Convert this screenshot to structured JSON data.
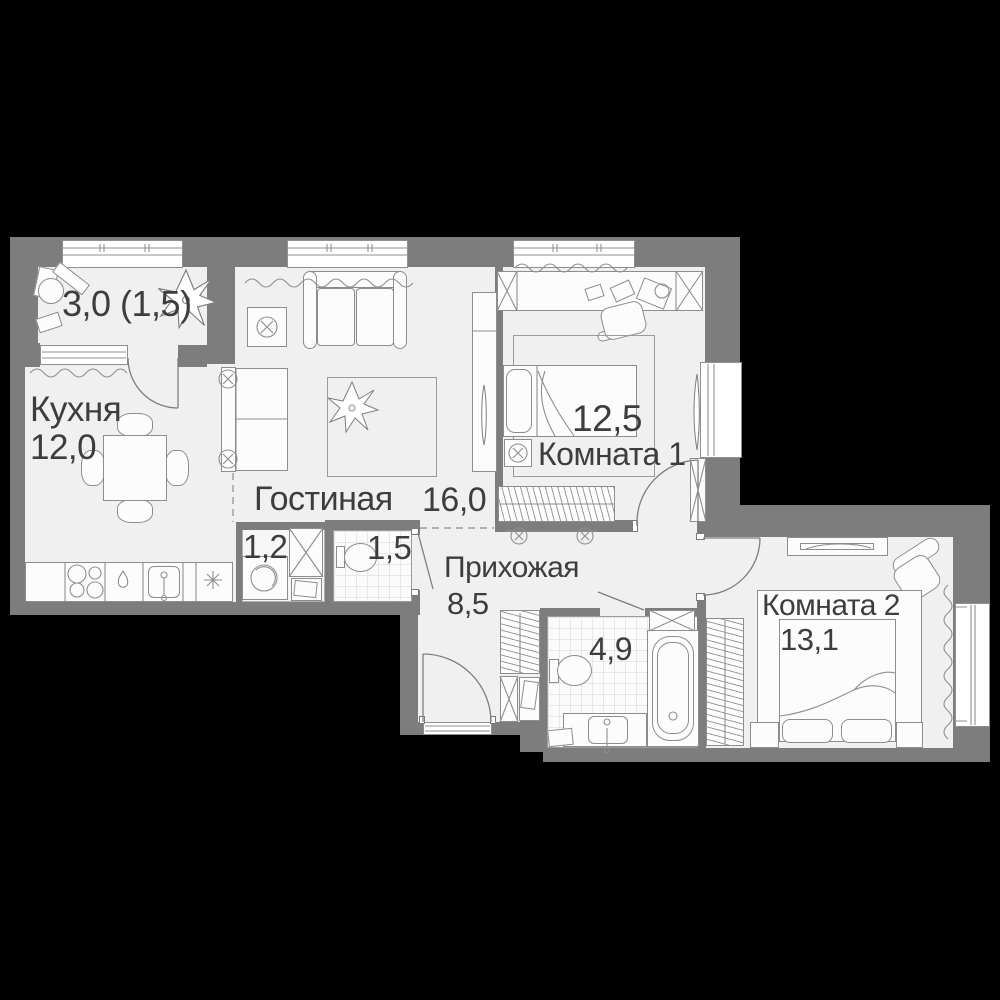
{
  "rooms": {
    "balcony": {
      "area": "3,0 (1,5)"
    },
    "kitchen": {
      "name": "Кухня",
      "area": "12,0"
    },
    "living": {
      "name": "Гостиная",
      "area": "16,0"
    },
    "room1": {
      "name": "Комната 1",
      "area": "12,5"
    },
    "room2": {
      "name": "Комната 2",
      "area": "13,1"
    },
    "hallway": {
      "name": "Прихожая",
      "area": "8,5"
    },
    "bathroom": {
      "area": "4,9"
    },
    "wc": {
      "area": "1,5"
    },
    "storage": {
      "area": "1,2"
    }
  },
  "fixtures": [
    "balcony-desk",
    "balcony-plant",
    "kitchen-table",
    "kitchen-counter",
    "stove-burners",
    "kitchen-sink",
    "fridge-snowflake",
    "sofa",
    "tv-table",
    "rug-plant",
    "wardrobe",
    "desk",
    "office-chair",
    "bed",
    "nightstand-lamp",
    "radiator",
    "washing-machine",
    "toilet",
    "bathtub",
    "vanity-sink",
    "armchair",
    "tv-stand",
    "curtain",
    "entrance-door"
  ],
  "colors": {
    "background": "#000000",
    "wall": "#7d7d7d",
    "floor": "#f0f0f0",
    "text": "#3d3d3d",
    "tile_line": "#e7e7e7"
  }
}
